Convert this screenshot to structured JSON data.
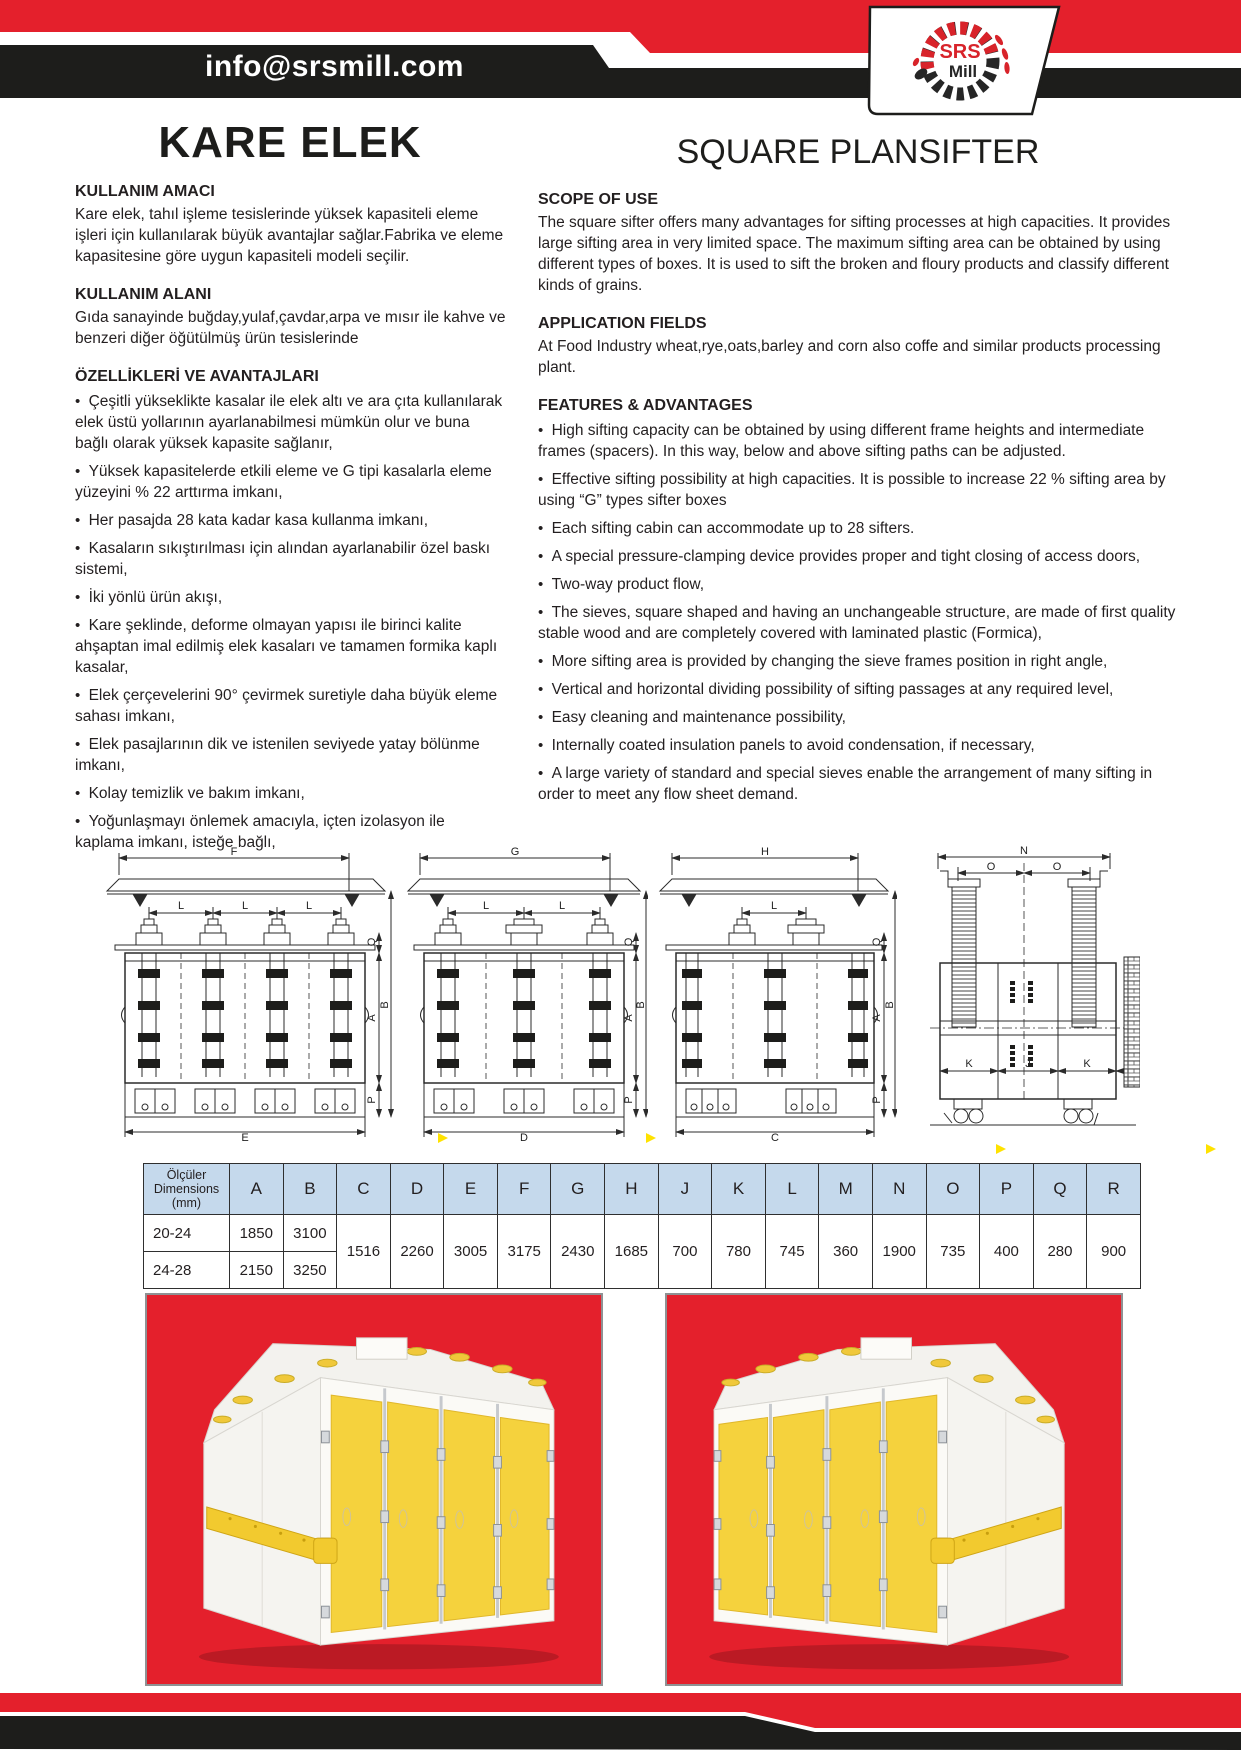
{
  "header": {
    "email": "info@srsmill.com",
    "logo": {
      "line1": "SRS",
      "line2": "Mill"
    }
  },
  "titles": {
    "tr": "KARE ELEK",
    "en": "SQUARE PLANSIFTER"
  },
  "sections": {
    "tr": {
      "purpose_heading": "KULLANIM AMACI",
      "purpose_text": "Kare elek, tahıl işleme tesislerinde yüksek kapasiteli eleme işleri için kullanılarak büyük avantajlar sağlar.Fabrika ve eleme kapasitesine göre uygun kapasiteli modeli seçilir.",
      "area_heading": "KULLANIM ALANI",
      "area_text": "Gıda  sanayinde buğday,yulaf,çavdar,arpa ve mısır ile kahve ve benzeri diğer öğütülmüş ürün tesislerinde",
      "features_heading": "ÖZELLİKLERİ VE AVANTAJLARI",
      "features": [
        "Çeşitli yükseklikte kasalar  ile elek altı ve ara çıta kullanılarak elek üstü yollarının ayarlanabilmesi mümkün olur ve buna bağlı olarak yüksek kapasite sağlanır,",
        "Yüksek kapasitelerde etkili eleme ve G tipi kasalarla eleme yüzeyini % 22 arttırma imkanı,",
        "Her pasajda 28 kata kadar kasa kullanma imkanı,",
        "Kasaların sıkıştırılması için alından ayarlanabilir özel baskı sistemi,",
        "İki yönlü ürün akışı,",
        "Kare şeklinde, deforme olmayan yapısı ile birinci kalite ahşaptan imal edilmiş elek kasaları ve tamamen formika kaplı kasalar,",
        "Elek çerçevelerini 90° çevirmek suretiyle daha büyük eleme sahası imkanı,",
        "Elek pasajlarının dik ve istenilen seviyede yatay bölünme imkanı,",
        "Kolay temizlik ve bakım imkanı,",
        "Yoğunlaşmayı önlemek amacıyla, içten izolasyon ile kaplama imkanı, isteğe bağlı,"
      ]
    },
    "en": {
      "scope_heading": "SCOPE OF USE",
      "scope_text": "The square sifter offers many advantages for sifting processes at high capacities. It provides large sifting area in very limited space. The maximum sifting area can be obtained by using different types of boxes. It is used to sift the broken and floury products and classify different kinds of grains.",
      "application_heading": "APPLICATION FIELDS",
      "application_text": "At Food Industry wheat,rye,oats,barley and corn also coffe and similar products processing plant.",
      "features_heading": "FEATURES & ADVANTAGES",
      "features": [
        "High sifting capacity can be obtained by using different frame heights and intermediate frames (spacers). In this way, below and above sifting paths can be adjusted.",
        "Effective sifting possibility at high capacities. It is possible to increase 22 % sifting area by using “G” types sifter boxes",
        "Each sifting cabin can accommodate up to 28 sifters.",
        "A special pressure-clamping device provides proper and tight closing of access doors,",
        "Two-way product flow,",
        "The sieves, square shaped and having an unchangeable structure, are made of first quality stable wood and are completely covered with laminated plastic (Formica),",
        "More sifting area is provided by changing the sieve frames position in right angle,",
        "Vertical and horizontal dividing possibility of sifting passages at any required level,",
        "Easy cleaning and maintenance possibility,",
        "Internally coated insulation panels to avoid condensation, if necessary,",
        "A large variety of standard and special sieves enable the arrangement of many sifting in order to meet any flow sheet demand."
      ]
    }
  },
  "drawings": {
    "d1": {
      "top": "F",
      "bottom": "E",
      "spans": [
        "L",
        "L",
        "L"
      ],
      "q": "Q",
      "a": "A",
      "b": "B",
      "p": "P"
    },
    "d2": {
      "top": "G",
      "bottom": "D",
      "spans": [
        "L",
        "L"
      ],
      "q": "Q",
      "a": "A",
      "b": "B",
      "p": "P"
    },
    "d3": {
      "top": "H",
      "bottom": "C",
      "spans": [
        "L"
      ],
      "q": "Q",
      "a": "A",
      "b": "B",
      "p": "P"
    },
    "d4": {
      "top": "N",
      "o1": "O",
      "o2": "O",
      "k1": "K",
      "j": "J",
      "k2": "K",
      "r": "R"
    }
  },
  "table": {
    "header_col": {
      "l1": "Ölçüler",
      "l2": "Dimensions",
      "l3": "(mm)"
    },
    "columns": [
      "A",
      "B",
      "C",
      "D",
      "E",
      "F",
      "G",
      "H",
      "J",
      "K",
      "L",
      "M",
      "N",
      "O",
      "P",
      "Q",
      "R"
    ],
    "rows": [
      {
        "model": "20-24",
        "a": "1850",
        "b": "3100"
      },
      {
        "model": "24-28",
        "a": "2150",
        "b": "3250"
      }
    ],
    "shared": {
      "c": "1516",
      "d": "2260",
      "e": "3005",
      "f": "3175",
      "g": "2430",
      "h": "1685",
      "j": "700",
      "k": "780",
      "l": "745",
      "m": "360",
      "n": "1900",
      "o": "735",
      "p": "400",
      "q": "280",
      "r": "900"
    }
  },
  "colors": {
    "brand_red": "#e4202c",
    "band_black": "#1d1d1b",
    "table_header_blue": "#c5d9ec",
    "machine_yellow": "#f5d23d"
  }
}
